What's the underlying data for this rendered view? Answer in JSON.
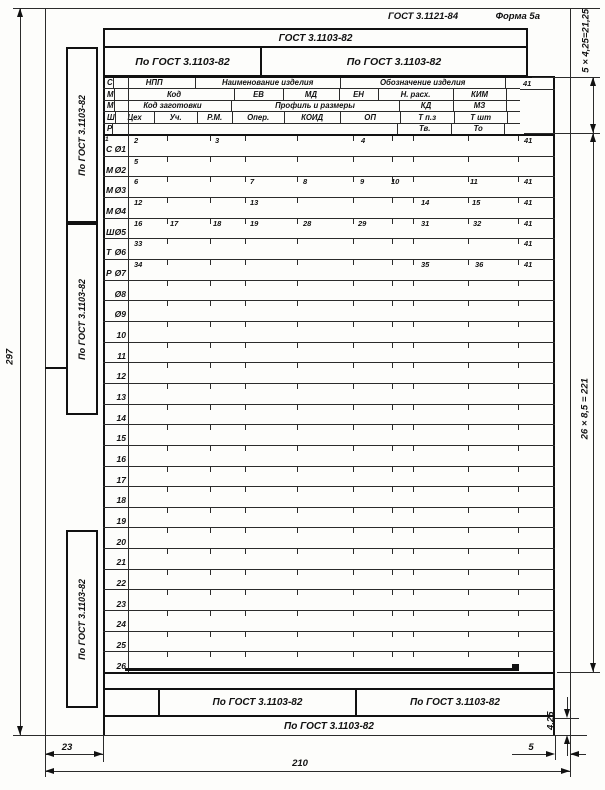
{
  "page_title": {
    "standard": "ГОСТ 3.1121-84",
    "form": "Форма 5а"
  },
  "top_block": {
    "row1": "ГОСТ 3.1103-82",
    "left_cell": "По ГОСТ 3.1103-82",
    "right_cell": "По ГОСТ 3.1103-82"
  },
  "side_blocks": {
    "block1": "По ГОСТ 3.1103-82",
    "block2": "По ГОСТ 3.1103-82",
    "block3": "По ГОСТ 3.1103-82"
  },
  "header": {
    "rows": [
      {
        "letter": "С",
        "cells": [
          "НПП",
          "Наименование изделия",
          "Обозначение изделия"
        ],
        "corner": "41"
      },
      {
        "letter": "М",
        "cells": [
          "Код",
          "ЕВ",
          "МД",
          "ЕН",
          "Н. расх.",
          "КИМ"
        ]
      },
      {
        "letter": "М",
        "cells": [
          "Код заготовки",
          "Профиль и размеры",
          "КД",
          "МЗ"
        ]
      },
      {
        "letter": "Ш",
        "cells": [
          "Цех",
          "Уч.",
          "Р.М.",
          "Опер.",
          "КОИД",
          "ОП",
          "Т п.з",
          "Т шт"
        ]
      },
      {
        "letter": "Р",
        "cells": [
          "",
          "Тв.",
          "То"
        ]
      }
    ]
  },
  "grid": {
    "rows": [
      {
        "label_prefix": "С",
        "label_num": "Ø1",
        "sup": "1",
        "fields": [
          {
            "n": "2",
            "x": 28
          },
          {
            "n": "3",
            "x": 109
          },
          {
            "n": "4",
            "x": 255
          },
          {
            "n": "41",
            "x": 418
          }
        ]
      },
      {
        "label_prefix": "М",
        "label_num": "Ø2",
        "fields": [
          {
            "n": "5",
            "x": 28
          }
        ]
      },
      {
        "label_prefix": "М",
        "label_num": "Ø3",
        "fields": [
          {
            "n": "6",
            "x": 28
          },
          {
            "n": "7",
            "x": 144
          },
          {
            "n": "8",
            "x": 197
          },
          {
            "n": "9",
            "x": 254
          },
          {
            "n": "10",
            "x": 285
          },
          {
            "n": "11",
            "x": 364
          },
          {
            "n": "41",
            "x": 418
          }
        ]
      },
      {
        "label_prefix": "М",
        "label_num": "Ø4",
        "fields": [
          {
            "n": "12",
            "x": 28
          },
          {
            "n": "13",
            "x": 144
          },
          {
            "n": "14",
            "x": 315
          },
          {
            "n": "15",
            "x": 366
          },
          {
            "n": "41",
            "x": 418
          }
        ]
      },
      {
        "label_prefix": "Ш",
        "label_num": "Ø5",
        "fields": [
          {
            "n": "16",
            "x": 28
          },
          {
            "n": "17",
            "x": 64
          },
          {
            "n": "18",
            "x": 107
          },
          {
            "n": "19",
            "x": 144
          },
          {
            "n": "28",
            "x": 197
          },
          {
            "n": "29",
            "x": 252
          },
          {
            "n": "31",
            "x": 315
          },
          {
            "n": "32",
            "x": 367
          },
          {
            "n": "41",
            "x": 418
          }
        ]
      },
      {
        "label_prefix": "Т",
        "label_num": "Ø6",
        "fields": [
          {
            "n": "33",
            "x": 28
          },
          {
            "n": "41",
            "x": 418
          }
        ]
      },
      {
        "label_prefix": "Р",
        "label_num": "Ø7",
        "fields": [
          {
            "n": "34",
            "x": 28
          },
          {
            "n": "35",
            "x": 315
          },
          {
            "n": "36",
            "x": 369
          },
          {
            "n": "41",
            "x": 418
          }
        ]
      },
      {
        "label_num": "Ø8",
        "fields": []
      },
      {
        "label_num": "Ø9",
        "fields": []
      },
      {
        "label_num": "10",
        "fields": []
      },
      {
        "label_num": "11",
        "fields": []
      },
      {
        "label_num": "12",
        "fields": []
      },
      {
        "label_num": "13",
        "fields": []
      },
      {
        "label_num": "14",
        "fields": []
      },
      {
        "label_num": "15",
        "fields": []
      },
      {
        "label_num": "16",
        "fields": []
      },
      {
        "label_num": "17",
        "fields": []
      },
      {
        "label_num": "18",
        "fields": []
      },
      {
        "label_num": "19",
        "fields": []
      },
      {
        "label_num": "20",
        "fields": []
      },
      {
        "label_num": "21",
        "fields": []
      },
      {
        "label_num": "22",
        "fields": []
      },
      {
        "label_num": "23",
        "fields": []
      },
      {
        "label_num": "24",
        "fields": []
      },
      {
        "label_num": "25",
        "fields": []
      },
      {
        "label_num": "26",
        "fields": []
      }
    ]
  },
  "footer_block": {
    "cell_center": "По ГОСТ 3.1103-82",
    "cell_right": "По ГОСТ 3.1103-82",
    "bottom_row": "По ГОСТ 3.1103-82"
  },
  "dimensions": {
    "sheet_height": "297",
    "left_margin": "23",
    "sheet_width": "210",
    "right_margin": "5",
    "header_calc": "5 × 4,25=21,25",
    "rows_calc": "26 × 8,5 = 221",
    "footer_calc": "4,25"
  }
}
